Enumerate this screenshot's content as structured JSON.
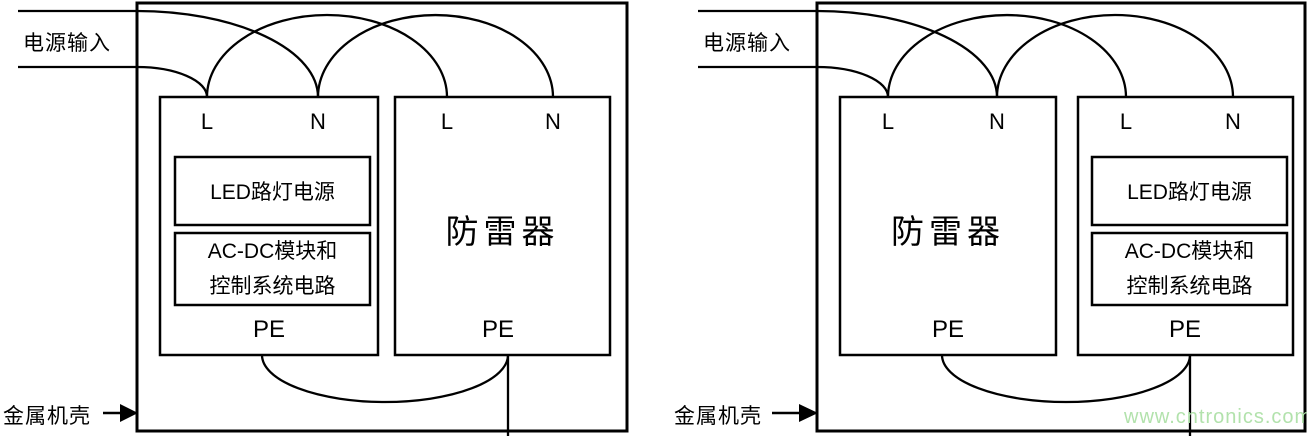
{
  "colors": {
    "line": "#000000",
    "background": "#ffffff",
    "watermark_green": "#b2e2ac"
  },
  "watermark": "www.cntronics.com",
  "left_diagram": {
    "power_input_label": "电源输入",
    "metal_case_label": "金属机壳",
    "led_unit": {
      "terminal_l": "L",
      "terminal_n": "N",
      "module_power": "LED路灯电源",
      "module_acdc_line1": "AC-DC模块和",
      "module_acdc_line2": "控制系统电路",
      "terminal_pe": "PE"
    },
    "surge_protector": {
      "terminal_l": "L",
      "terminal_n": "N",
      "title": "防雷器",
      "terminal_pe": "PE"
    }
  },
  "right_diagram": {
    "power_input_label": "电源输入",
    "metal_case_label": "金属机壳",
    "surge_protector": {
      "terminal_l": "L",
      "terminal_n": "N",
      "title": "防雷器",
      "terminal_pe": "PE"
    },
    "led_unit": {
      "terminal_l": "L",
      "terminal_n": "N",
      "module_power": "LED路灯电源",
      "module_acdc_line1": "AC-DC模块和",
      "module_acdc_line2": "控制系统电路",
      "terminal_pe": "PE"
    }
  }
}
